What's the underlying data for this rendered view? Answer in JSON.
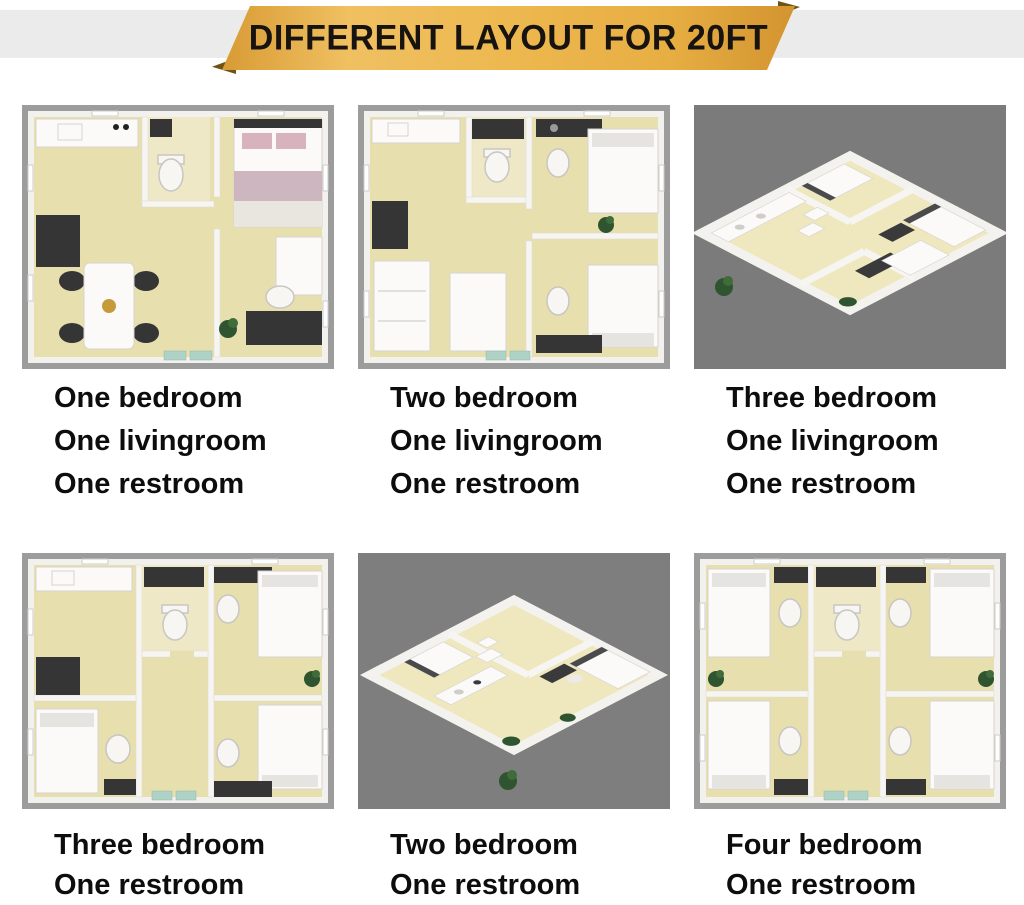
{
  "banner": {
    "title": "DIFFERENT LAYOUT FOR 20FT"
  },
  "colors": {
    "banner_gold": "#EDB84F",
    "banner_gold_dark": "#D3942F",
    "fold_dark": "#6E5314",
    "strip_gray": "#EBEBEB",
    "caption_black": "#0D0D0D",
    "floor_beige": "#E8DFAE",
    "wall_white": "#F2F1EE",
    "plan_border_gray": "#9C9C9C",
    "iso_background_gray": "#7B7B7B",
    "plant_green": "#2F5430",
    "bed_pink": "#D8B3BD"
  },
  "panels": [
    {
      "id": "one-bedroom",
      "view": "top-down",
      "alt": "Top-down 3D floor plan: one bedroom, one livingroom, one restroom",
      "caption_lines": [
        "One bedroom",
        "One livingroom",
        "One restroom"
      ]
    },
    {
      "id": "two-bedroom-living",
      "view": "top-down",
      "alt": "Top-down 3D floor plan: two bedroom, one livingroom, one restroom",
      "caption_lines": [
        "Two bedroom",
        "One livingroom",
        "One restroom"
      ]
    },
    {
      "id": "three-bedroom-living",
      "view": "isometric",
      "alt": "Isometric 3D floor plan: three bedroom, one livingroom, one restroom",
      "caption_lines": [
        "Three bedroom",
        "One livingroom",
        "One restroom"
      ]
    },
    {
      "id": "three-bedroom",
      "view": "top-down",
      "alt": "Top-down 3D floor plan: three bedroom, one restroom",
      "caption_lines": [
        "Three bedroom",
        "One restroom"
      ]
    },
    {
      "id": "two-bedroom",
      "view": "isometric",
      "alt": "Isometric 3D floor plan: two bedroom, one restroom",
      "caption_lines": [
        "Two bedroom",
        "One restroom"
      ]
    },
    {
      "id": "four-bedroom",
      "view": "top-down",
      "alt": "Top-down 3D floor plan: four bedroom, one restroom",
      "caption_lines": [
        "Four bedroom",
        "One restroom"
      ]
    }
  ]
}
